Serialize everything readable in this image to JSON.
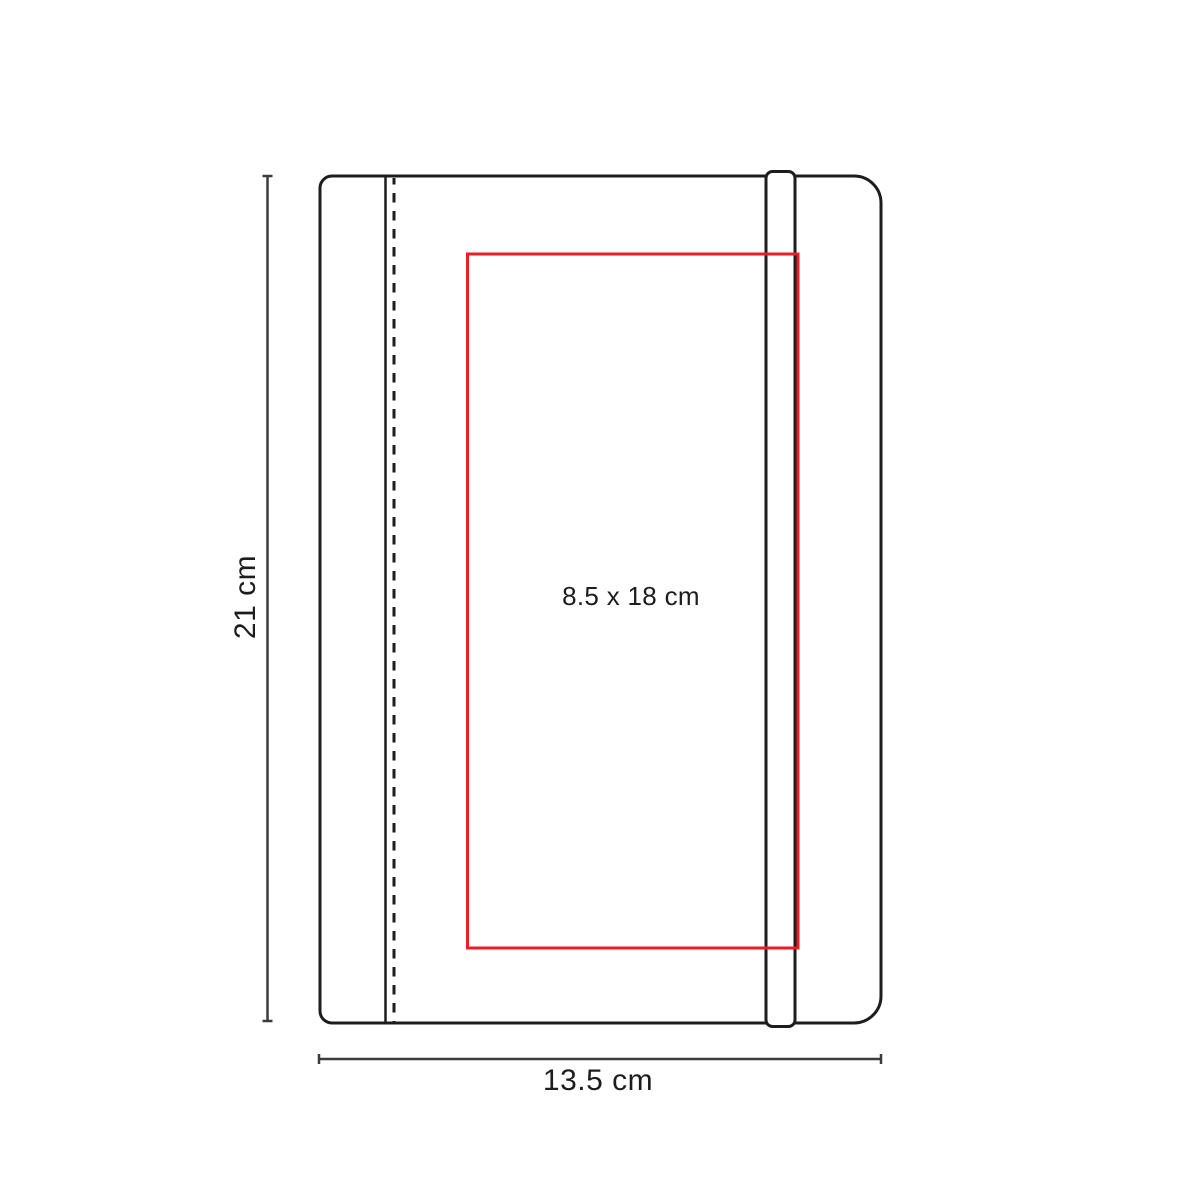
{
  "diagram": {
    "subject": "notebook-with-elastic-band-print-area-spec",
    "labels": {
      "height": "21 cm",
      "width": "13.5 cm",
      "print_area": "8.5 x 18 cm"
    },
    "colors": {
      "outline": "#1d1d1b",
      "dimension": "#3c3c3c",
      "print_area": "#ed1c24",
      "background": "#ffffff"
    }
  }
}
